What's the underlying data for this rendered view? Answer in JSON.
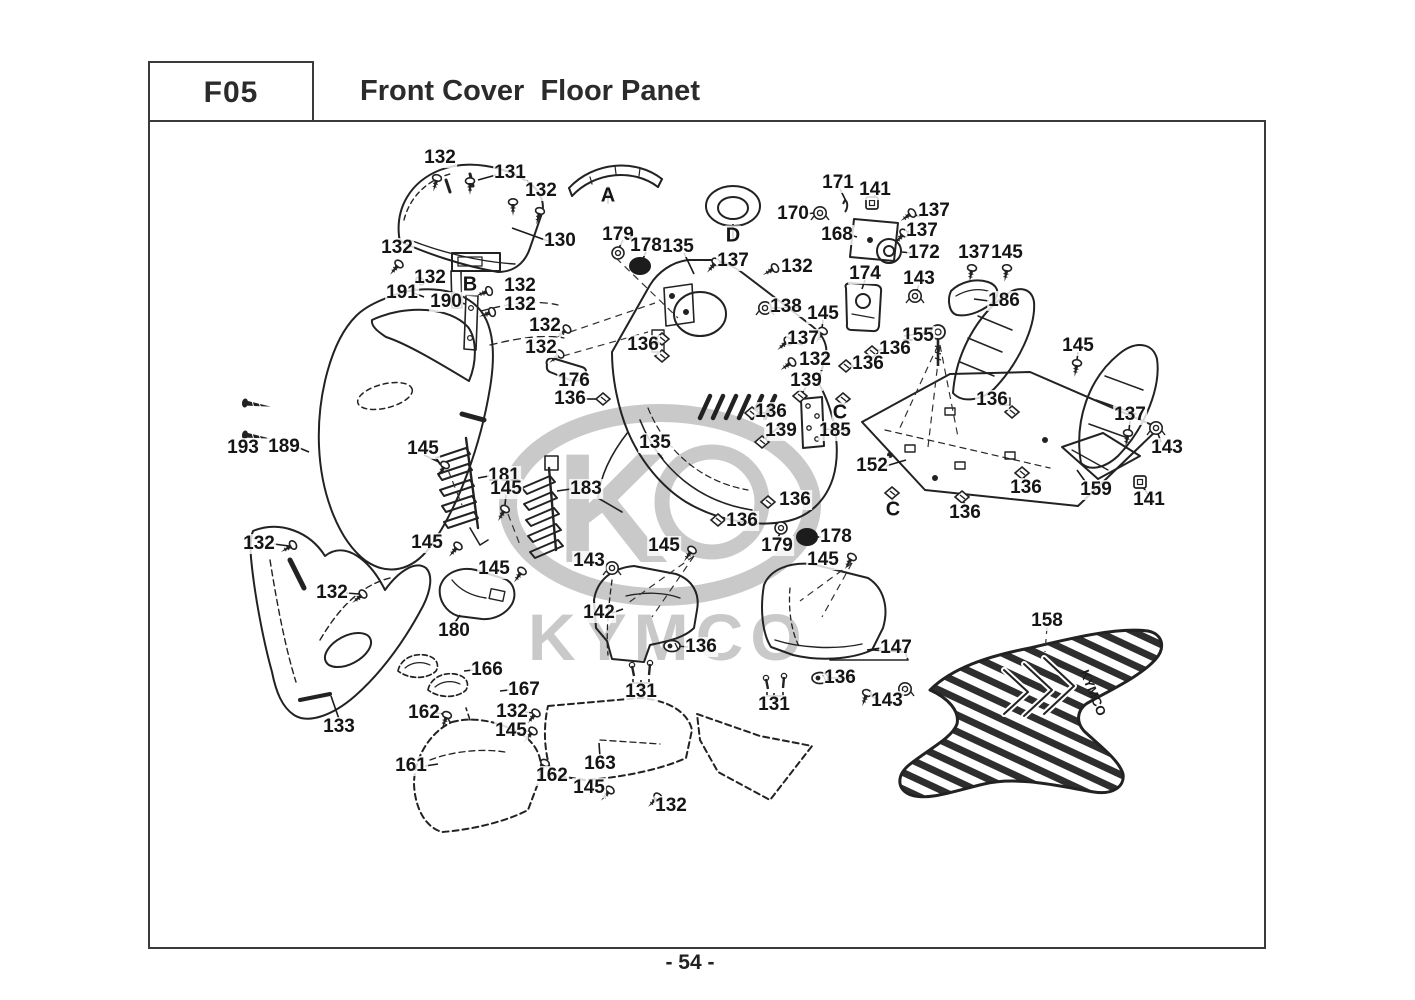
{
  "header": {
    "code": "F05",
    "title": "Front Cover  Floor Panet"
  },
  "footer": {
    "page_number": "- 54 -"
  },
  "watermark": {
    "text": "KYMCO",
    "k": "K",
    "mat_text": "KYMCO",
    "color": "#c9c9c9"
  },
  "diagram": {
    "line_color": "#222222",
    "labels": [
      {
        "t": "132",
        "x": 440,
        "y": 158
      },
      {
        "t": "131",
        "x": 510,
        "y": 173
      },
      {
        "t": "132",
        "x": 541,
        "y": 191
      },
      {
        "t": "130",
        "x": 560,
        "y": 241
      },
      {
        "t": "A",
        "x": 608,
        "y": 196
      },
      {
        "t": "179",
        "x": 618,
        "y": 235
      },
      {
        "t": "178",
        "x": 646,
        "y": 246
      },
      {
        "t": "135",
        "x": 678,
        "y": 247
      },
      {
        "t": "D",
        "x": 733,
        "y": 236
      },
      {
        "t": "137",
        "x": 733,
        "y": 261
      },
      {
        "t": "170",
        "x": 793,
        "y": 214
      },
      {
        "t": "171",
        "x": 838,
        "y": 183
      },
      {
        "t": "141",
        "x": 875,
        "y": 190
      },
      {
        "t": "137",
        "x": 934,
        "y": 211
      },
      {
        "t": "168",
        "x": 837,
        "y": 235
      },
      {
        "t": "137",
        "x": 922,
        "y": 231
      },
      {
        "t": "172",
        "x": 924,
        "y": 253
      },
      {
        "t": "137",
        "x": 974,
        "y": 253
      },
      {
        "t": "145",
        "x": 1007,
        "y": 253
      },
      {
        "t": "174",
        "x": 865,
        "y": 274
      },
      {
        "t": "143",
        "x": 919,
        "y": 279
      },
      {
        "t": "186",
        "x": 1004,
        "y": 301
      },
      {
        "t": "132",
        "x": 797,
        "y": 267
      },
      {
        "t": "138",
        "x": 786,
        "y": 307
      },
      {
        "t": "145",
        "x": 823,
        "y": 314
      },
      {
        "t": "155",
        "x": 918,
        "y": 336
      },
      {
        "t": "136",
        "x": 895,
        "y": 349
      },
      {
        "t": "137",
        "x": 803,
        "y": 339
      },
      {
        "t": "132",
        "x": 815,
        "y": 360
      },
      {
        "t": "136",
        "x": 868,
        "y": 364
      },
      {
        "t": "139",
        "x": 806,
        "y": 381
      },
      {
        "t": "C",
        "x": 840,
        "y": 413
      },
      {
        "t": "136",
        "x": 771,
        "y": 412
      },
      {
        "t": "139",
        "x": 781,
        "y": 431
      },
      {
        "t": "185",
        "x": 835,
        "y": 431
      },
      {
        "t": "145",
        "x": 1078,
        "y": 346
      },
      {
        "t": "136",
        "x": 992,
        "y": 400
      },
      {
        "t": "137",
        "x": 1130,
        "y": 415
      },
      {
        "t": "143",
        "x": 1167,
        "y": 448
      },
      {
        "t": "152",
        "x": 872,
        "y": 466
      },
      {
        "t": "136",
        "x": 1026,
        "y": 488
      },
      {
        "t": "159",
        "x": 1096,
        "y": 490
      },
      {
        "t": "141",
        "x": 1149,
        "y": 500
      },
      {
        "t": "136",
        "x": 965,
        "y": 513
      },
      {
        "t": "C",
        "x": 893,
        "y": 510
      },
      {
        "t": "136",
        "x": 795,
        "y": 500
      },
      {
        "t": "136",
        "x": 742,
        "y": 521
      },
      {
        "t": "179",
        "x": 777,
        "y": 546
      },
      {
        "t": "178",
        "x": 836,
        "y": 537
      },
      {
        "t": "145",
        "x": 823,
        "y": 560
      },
      {
        "t": "145",
        "x": 664,
        "y": 546
      },
      {
        "t": "143",
        "x": 589,
        "y": 561
      },
      {
        "t": "142",
        "x": 599,
        "y": 613
      },
      {
        "t": "136",
        "x": 701,
        "y": 647
      },
      {
        "t": "131",
        "x": 641,
        "y": 692
      },
      {
        "t": "147",
        "x": 896,
        "y": 648
      },
      {
        "t": "136",
        "x": 840,
        "y": 678
      },
      {
        "t": "143",
        "x": 887,
        "y": 701
      },
      {
        "t": "131",
        "x": 774,
        "y": 705
      },
      {
        "t": "158",
        "x": 1047,
        "y": 621
      },
      {
        "t": "193",
        "x": 243,
        "y": 448
      },
      {
        "t": "189",
        "x": 284,
        "y": 447
      },
      {
        "t": "145",
        "x": 423,
        "y": 449
      },
      {
        "t": "181",
        "x": 504,
        "y": 476
      },
      {
        "t": "145",
        "x": 506,
        "y": 489
      },
      {
        "t": "183",
        "x": 586,
        "y": 489
      },
      {
        "t": "132",
        "x": 259,
        "y": 544
      },
      {
        "t": "145",
        "x": 427,
        "y": 543
      },
      {
        "t": "145",
        "x": 494,
        "y": 569
      },
      {
        "t": "132",
        "x": 332,
        "y": 593
      },
      {
        "t": "180",
        "x": 454,
        "y": 631
      },
      {
        "t": "133",
        "x": 339,
        "y": 727
      },
      {
        "t": "166",
        "x": 487,
        "y": 670
      },
      {
        "t": "167",
        "x": 524,
        "y": 690
      },
      {
        "t": "162",
        "x": 424,
        "y": 713
      },
      {
        "t": "132",
        "x": 512,
        "y": 712
      },
      {
        "t": "145",
        "x": 511,
        "y": 731
      },
      {
        "t": "161",
        "x": 411,
        "y": 766
      },
      {
        "t": "162",
        "x": 552,
        "y": 776
      },
      {
        "t": "163",
        "x": 600,
        "y": 764
      },
      {
        "t": "145",
        "x": 589,
        "y": 788
      },
      {
        "t": "132",
        "x": 671,
        "y": 806
      },
      {
        "t": "176",
        "x": 574,
        "y": 381
      },
      {
        "t": "136",
        "x": 570,
        "y": 399
      },
      {
        "t": "132",
        "x": 397,
        "y": 248
      },
      {
        "t": "132",
        "x": 430,
        "y": 278
      },
      {
        "t": "191",
        "x": 402,
        "y": 293
      },
      {
        "t": "190",
        "x": 446,
        "y": 302
      },
      {
        "t": "B",
        "x": 470,
        "y": 285
      },
      {
        "t": "132",
        "x": 520,
        "y": 286
      },
      {
        "t": "132",
        "x": 520,
        "y": 305
      },
      {
        "t": "132",
        "x": 545,
        "y": 326
      },
      {
        "t": "132",
        "x": 541,
        "y": 348
      },
      {
        "t": "136",
        "x": 643,
        "y": 345
      },
      {
        "t": "135",
        "x": 655,
        "y": 443
      }
    ],
    "leads": [
      [
        548,
        241,
        512,
        228
      ],
      [
        496,
        175,
        478,
        180
      ],
      [
        608,
        204,
        608,
        186
      ],
      [
        733,
        241,
        733,
        224
      ],
      [
        646,
        252,
        642,
        261
      ],
      [
        623,
        240,
        619,
        248
      ],
      [
        684,
        253,
        694,
        274
      ],
      [
        805,
        214,
        814,
        213
      ],
      [
        840,
        189,
        846,
        201
      ],
      [
        875,
        195,
        873,
        201
      ],
      [
        850,
        235,
        857,
        237
      ],
      [
        911,
        253,
        902,
        252
      ],
      [
        920,
        217,
        914,
        214
      ],
      [
        909,
        231,
        906,
        232
      ],
      [
        865,
        280,
        862,
        289
      ],
      [
        919,
        285,
        916,
        292
      ],
      [
        989,
        301,
        974,
        299
      ],
      [
        798,
        307,
        772,
        308
      ],
      [
        823,
        320,
        822,
        328
      ],
      [
        904,
        336,
        930,
        332
      ],
      [
        882,
        349,
        875,
        352
      ],
      [
        803,
        345,
        792,
        342
      ],
      [
        806,
        387,
        802,
        393
      ],
      [
        840,
        407,
        843,
        401
      ],
      [
        783,
        412,
        760,
        413
      ],
      [
        781,
        425,
        766,
        438
      ],
      [
        848,
        431,
        826,
        429
      ],
      [
        1078,
        352,
        1077,
        360
      ],
      [
        1130,
        421,
        1129,
        430
      ],
      [
        1161,
        442,
        1157,
        431
      ],
      [
        886,
        466,
        906,
        460
      ],
      [
        1087,
        484,
        1077,
        470
      ],
      [
        1148,
        494,
        1142,
        486
      ],
      [
        1026,
        482,
        1023,
        476
      ],
      [
        965,
        507,
        963,
        499
      ],
      [
        893,
        504,
        892,
        496
      ],
      [
        777,
        540,
        781,
        531
      ],
      [
        821,
        537,
        814,
        537
      ],
      [
        655,
        449,
        663,
        459
      ],
      [
        585,
        399,
        597,
        399
      ],
      [
        650,
        345,
        658,
        342
      ],
      [
        612,
        613,
        623,
        609
      ],
      [
        881,
        648,
        867,
        650
      ],
      [
        854,
        678,
        828,
        678
      ],
      [
        688,
        647,
        678,
        646
      ],
      [
        879,
        700,
        871,
        696
      ],
      [
        641,
        686,
        641,
        680
      ],
      [
        774,
        699,
        774,
        693
      ],
      [
        297,
        447,
        309,
        452
      ],
      [
        339,
        719,
        331,
        696
      ],
      [
        274,
        544,
        289,
        546
      ],
      [
        346,
        593,
        359,
        594
      ],
      [
        424,
        455,
        439,
        462
      ],
      [
        506,
        495,
        505,
        505
      ],
      [
        489,
        476,
        478,
        478
      ],
      [
        571,
        489,
        557,
        491
      ],
      [
        454,
        624,
        460,
        615
      ],
      [
        473,
        670,
        464,
        671
      ],
      [
        509,
        690,
        500,
        691
      ],
      [
        436,
        713,
        444,
        714
      ],
      [
        552,
        769,
        547,
        765
      ],
      [
        525,
        712,
        533,
        713
      ],
      [
        524,
        731,
        529,
        731
      ],
      [
        425,
        766,
        438,
        764
      ],
      [
        600,
        757,
        599,
        743
      ],
      [
        601,
        788,
        607,
        789
      ],
      [
        660,
        806,
        659,
        800
      ],
      [
        459,
        302,
        465,
        304
      ],
      [
        414,
        293,
        424,
        297
      ]
    ],
    "dashes": [
      [
        1047,
        627,
        1045,
        652
      ],
      [
        570,
        332,
        655,
        303
      ],
      [
        563,
        356,
        648,
        332
      ],
      [
        938,
        345,
        898,
        432
      ],
      [
        940,
        345,
        928,
        447
      ],
      [
        940,
        345,
        958,
        437
      ],
      [
        694,
        556,
        628,
        603
      ],
      [
        694,
        556,
        652,
        617
      ],
      [
        852,
        563,
        800,
        601
      ],
      [
        852,
        563,
        822,
        617
      ],
      [
        616,
        258,
        678,
        318
      ],
      [
        448,
        470,
        462,
        505
      ],
      [
        508,
        514,
        520,
        545
      ]
    ],
    "fasteners": [
      {
        "k": "screw",
        "x": 437,
        "y": 178,
        "r": 15
      },
      {
        "k": "screw",
        "x": 470,
        "y": 181,
        "r": 0
      },
      {
        "k": "screw",
        "x": 513,
        "y": 202,
        "r": 0
      },
      {
        "k": "screw",
        "x": 540,
        "y": 211,
        "r": 15
      },
      {
        "k": "screw",
        "x": 399,
        "y": 264,
        "r": 40
      },
      {
        "k": "screw",
        "x": 420,
        "y": 281,
        "r": 40
      },
      {
        "k": "screw",
        "x": 489,
        "y": 291,
        "r": 70
      },
      {
        "k": "screw",
        "x": 492,
        "y": 312,
        "r": 70
      },
      {
        "k": "screw",
        "x": 567,
        "y": 329,
        "r": 50
      },
      {
        "k": "screw",
        "x": 560,
        "y": 354,
        "r": 50
      },
      {
        "k": "screw",
        "x": 293,
        "y": 545,
        "r": 60
      },
      {
        "k": "screw",
        "x": 363,
        "y": 594,
        "r": 50
      },
      {
        "k": "screw",
        "x": 775,
        "y": 268,
        "r": 60
      },
      {
        "k": "screw",
        "x": 788,
        "y": 341,
        "r": 50
      },
      {
        "k": "screw",
        "x": 792,
        "y": 362,
        "r": 55
      },
      {
        "k": "screw",
        "x": 912,
        "y": 213,
        "r": 55
      },
      {
        "k": "screw",
        "x": 904,
        "y": 233,
        "r": 40
      },
      {
        "k": "screw",
        "x": 972,
        "y": 268,
        "r": 10
      },
      {
        "k": "screw",
        "x": 1007,
        "y": 268,
        "r": 10
      },
      {
        "k": "screw",
        "x": 823,
        "y": 331,
        "r": 30
      },
      {
        "k": "screw",
        "x": 1077,
        "y": 363,
        "r": 10
      },
      {
        "k": "screw",
        "x": 1128,
        "y": 433,
        "r": 10
      },
      {
        "k": "screw",
        "x": 867,
        "y": 693,
        "r": 20
      },
      {
        "k": "screw",
        "x": 692,
        "y": 550,
        "r": 35
      },
      {
        "k": "screw",
        "x": 445,
        "y": 465,
        "r": 30
      },
      {
        "k": "screw",
        "x": 505,
        "y": 509,
        "r": 30
      },
      {
        "k": "screw",
        "x": 522,
        "y": 571,
        "r": 35
      },
      {
        "k": "screw",
        "x": 533,
        "y": 731,
        "r": 40
      },
      {
        "k": "screw",
        "x": 610,
        "y": 790,
        "r": 40
      },
      {
        "k": "screw",
        "x": 852,
        "y": 557,
        "r": 30
      },
      {
        "k": "screw",
        "x": 458,
        "y": 546,
        "r": 40
      },
      {
        "k": "screw",
        "x": 447,
        "y": 715,
        "r": 20
      },
      {
        "k": "screw",
        "x": 545,
        "y": 763,
        "r": 30
      },
      {
        "k": "screw",
        "x": 536,
        "y": 713,
        "r": 40
      },
      {
        "k": "screw",
        "x": 658,
        "y": 797,
        "r": 45
      },
      {
        "k": "screw",
        "x": 716,
        "y": 262,
        "r": 40
      },
      {
        "k": "lscrew",
        "x": 245,
        "y": 403,
        "r": 8
      },
      {
        "k": "lscrew",
        "x": 245,
        "y": 435,
        "r": 8
      },
      {
        "k": "clip",
        "x": 603,
        "y": 399,
        "r": 0
      },
      {
        "k": "clip",
        "x": 662,
        "y": 339,
        "r": 0
      },
      {
        "k": "clip",
        "x": 662,
        "y": 356,
        "r": 0
      },
      {
        "k": "clip",
        "x": 752,
        "y": 413,
        "r": 0
      },
      {
        "k": "clip",
        "x": 800,
        "y": 396,
        "r": 0
      },
      {
        "k": "clip",
        "x": 843,
        "y": 399,
        "r": 0
      },
      {
        "k": "clip",
        "x": 892,
        "y": 493,
        "r": 0
      },
      {
        "k": "clip",
        "x": 762,
        "y": 442,
        "r": 0
      },
      {
        "k": "clip",
        "x": 872,
        "y": 352,
        "r": 0
      },
      {
        "k": "clip",
        "x": 846,
        "y": 366,
        "r": 0
      },
      {
        "k": "clip",
        "x": 1022,
        "y": 473,
        "r": 0
      },
      {
        "k": "clip",
        "x": 962,
        "y": 497,
        "r": 0
      },
      {
        "k": "clip",
        "x": 718,
        "y": 520,
        "r": 0
      },
      {
        "k": "clip",
        "x": 768,
        "y": 502,
        "r": 0
      },
      {
        "k": "clip",
        "x": 1012,
        "y": 412,
        "r": 0
      },
      {
        "k": "oclip",
        "x": 672,
        "y": 646,
        "r": 0
      },
      {
        "k": "oclip",
        "x": 820,
        "y": 678,
        "r": 0
      },
      {
        "k": "nut",
        "x": 820,
        "y": 213,
        "r": 0
      },
      {
        "k": "nut",
        "x": 765,
        "y": 308,
        "r": 0
      },
      {
        "k": "nut",
        "x": 1156,
        "y": 428,
        "r": 0
      },
      {
        "k": "nut",
        "x": 905,
        "y": 689,
        "r": 0
      },
      {
        "k": "nut",
        "x": 612,
        "y": 568,
        "r": 0
      },
      {
        "k": "nut",
        "x": 915,
        "y": 296,
        "r": 0
      },
      {
        "k": "ring",
        "x": 618,
        "y": 253,
        "r": 0
      },
      {
        "k": "ring",
        "x": 781,
        "y": 528,
        "r": 0
      },
      {
        "k": "pad",
        "x": 640,
        "y": 266,
        "r": 0
      },
      {
        "k": "pad",
        "x": 807,
        "y": 537,
        "r": 0
      },
      {
        "k": "pair",
        "x": 641,
        "y": 674,
        "r": 0
      },
      {
        "k": "pair",
        "x": 775,
        "y": 687,
        "r": 0
      },
      {
        "k": "sq",
        "x": 872,
        "y": 203,
        "r": 0
      },
      {
        "k": "sq",
        "x": 1140,
        "y": 482,
        "r": 0
      },
      {
        "k": "pin",
        "x": 845,
        "y": 206,
        "r": 0
      },
      {
        "k": "bolt",
        "x": 938,
        "y": 332,
        "r": 0
      }
    ]
  }
}
